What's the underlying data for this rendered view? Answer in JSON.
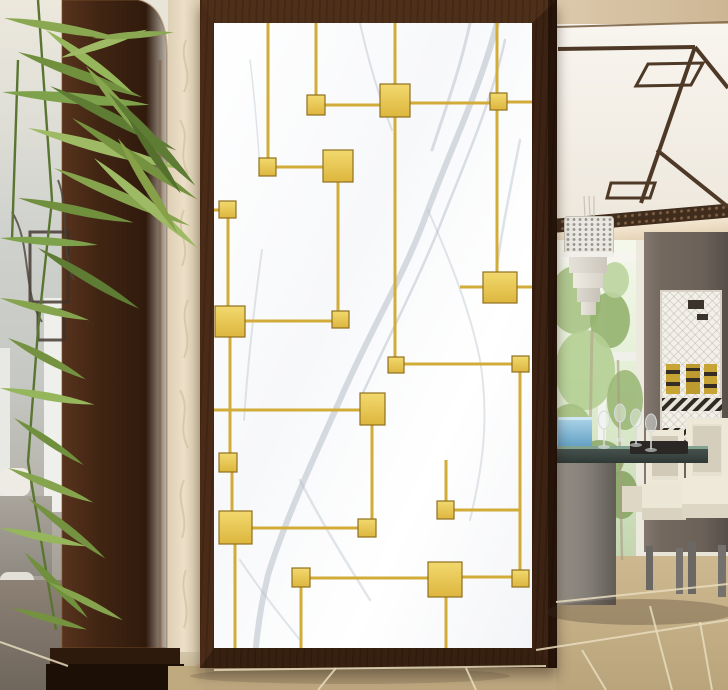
{
  "scene": {
    "description": "Hallway interior photo: white marble partition screen with gold geometric square pattern in a dark wood frame; dark wood arch and bamboo plant at left; dining room with fretwork ceiling, chandelier, window, table and chairs at right; beige tile floor",
    "colors": {
      "gold": "#e7c04c",
      "gold_line": "#d2ac38",
      "gold_edge": "#8f7020",
      "wood": "#4a2b18",
      "wood_dark": "#2a160b",
      "marble": "#fdfdfd",
      "vein": "#b7bec9",
      "wallpaper": "#ecdfc8",
      "fret": "#4e3926",
      "lattice_band": "#3f2c1c",
      "wall_column": "#6f645e",
      "window_green": "#a9c486",
      "floor": "#c3ad85",
      "grout": "#e8dcbd",
      "left_floor": "#847a6e",
      "chair": "#e7e1d1",
      "table": "#37423f",
      "stem": "#5a7531"
    }
  },
  "panel": {
    "vein_color": "#b7bec9",
    "line_color": "#d2ac38",
    "square_edge": "#8f7020",
    "squares": [
      [
        307,
        95,
        18,
        20
      ],
      [
        380,
        84,
        30,
        33
      ],
      [
        490,
        93,
        17,
        17
      ],
      [
        323,
        150,
        30,
        32
      ],
      [
        259,
        158,
        17,
        18
      ],
      [
        219,
        201,
        17,
        17
      ],
      [
        215,
        306,
        30,
        31
      ],
      [
        332,
        311,
        17,
        17
      ],
      [
        483,
        272,
        34,
        31
      ],
      [
        388,
        357,
        16,
        16
      ],
      [
        512,
        356,
        17,
        16
      ],
      [
        360,
        393,
        25,
        32
      ],
      [
        219,
        453,
        18,
        19
      ],
      [
        219,
        511,
        33,
        33
      ],
      [
        358,
        519,
        18,
        18
      ],
      [
        437,
        501,
        17,
        18
      ],
      [
        292,
        568,
        18,
        19
      ],
      [
        428,
        562,
        34,
        35
      ],
      [
        512,
        570,
        17,
        17
      ]
    ],
    "lines": [
      [
        268,
        23,
        268,
        158
      ],
      [
        316,
        23,
        316,
        95
      ],
      [
        395,
        23,
        395,
        84
      ],
      [
        395,
        117,
        395,
        357
      ],
      [
        497,
        23,
        497,
        93
      ],
      [
        497,
        110,
        497,
        272
      ],
      [
        338,
        182,
        338,
        311
      ],
      [
        228,
        218,
        228,
        306
      ],
      [
        230,
        337,
        230,
        453
      ],
      [
        232,
        472,
        232,
        511
      ],
      [
        235,
        544,
        235,
        648
      ],
      [
        372,
        425,
        372,
        519
      ],
      [
        520,
        372,
        520,
        570
      ],
      [
        446,
        460,
        446,
        501
      ],
      [
        446,
        597,
        446,
        648
      ],
      [
        301,
        587,
        301,
        648
      ],
      [
        325,
        105,
        380,
        105
      ],
      [
        410,
        103,
        490,
        103
      ],
      [
        507,
        102,
        532,
        102
      ],
      [
        276,
        167,
        323,
        167
      ],
      [
        214,
        210,
        219,
        210
      ],
      [
        245,
        321,
        332,
        321
      ],
      [
        460,
        287,
        483,
        287
      ],
      [
        517,
        287,
        532,
        287
      ],
      [
        404,
        364,
        512,
        364
      ],
      [
        214,
        410,
        360,
        410
      ],
      [
        252,
        528,
        358,
        528
      ],
      [
        454,
        510,
        520,
        510
      ],
      [
        310,
        578,
        428,
        578
      ],
      [
        462,
        577,
        512,
        577
      ]
    ],
    "veins": [
      {
        "d": "M497,23 C480,90 450,150 428,210 C405,275 370,330 340,400 C315,455 285,520 268,575 C262,600 258,625 256,647",
        "w": 6,
        "o": 0.55
      },
      {
        "d": "M505,40 C492,100 466,160 444,215 C424,268 392,330 362,395",
        "w": 2.5,
        "o": 0.5
      },
      {
        "d": "M470,23 C460,70 445,110 432,150",
        "w": 3,
        "o": 0.5
      },
      {
        "d": "M520,140 C510,190 500,240 497,268",
        "w": 2.5,
        "o": 0.45
      },
      {
        "d": "M428,210 C450,260 470,310 480,360 C490,420 482,470 470,520",
        "w": 2,
        "o": 0.4
      },
      {
        "d": "M262,250 C255,300 248,360 244,420",
        "w": 2,
        "o": 0.4
      },
      {
        "d": "M300,480 C320,520 345,560 370,600",
        "w": 2.5,
        "o": 0.4
      },
      {
        "d": "M240,560 C260,590 280,615 300,640",
        "w": 2,
        "o": 0.4
      },
      {
        "d": "M250,60 C255,100 258,140 260,170",
        "w": 1.5,
        "o": 0.4
      },
      {
        "d": "M360,23 C368,60 380,100 392,130",
        "w": 2,
        "o": 0.45
      }
    ]
  },
  "ceiling_fret": [
    {
      "d": "M557,27 L728,22",
      "w": 2,
      "c": "#8a7257"
    },
    {
      "d": "M558,49 L695,47",
      "w": 4
    },
    {
      "d": "M695,47 L641,203",
      "w": 4
    },
    {
      "d": "M648,64 L703,63 L691,85 L636,86 Z",
      "w": 3
    },
    {
      "d": "M611,183 L655,183 L650,198 L607,198 Z",
      "w": 3
    },
    {
      "d": "M657,150 L728,207",
      "w": 4
    },
    {
      "d": "M728,88 L695,47",
      "w": 4
    }
  ],
  "chandelier_cables": [
    [
      584,
      196,
      585,
      218
    ],
    [
      589,
      196,
      590,
      218
    ],
    [
      594,
      196,
      594,
      218
    ]
  ],
  "window_trees": [
    [
      575,
      300,
      26,
      34,
      "#a8c386"
    ],
    [
      610,
      320,
      20,
      28,
      "#93b26e"
    ],
    [
      585,
      370,
      30,
      40,
      "#b4cf94"
    ],
    [
      625,
      400,
      18,
      30,
      "#9cb878"
    ],
    [
      570,
      430,
      22,
      26,
      "#a4bf80"
    ],
    [
      615,
      280,
      14,
      18,
      "#bcd49e"
    ],
    [
      600,
      460,
      24,
      20,
      "#8fa96a"
    ],
    [
      580,
      505,
      26,
      22,
      "#9db873"
    ],
    [
      622,
      495,
      16,
      24,
      "#8aa566"
    ]
  ],
  "inset_motifs": [
    [
      666,
      364,
      14,
      30,
      "#c7a433"
    ],
    [
      686,
      364,
      14,
      30,
      "#bd9b2e"
    ],
    [
      704,
      364,
      13,
      30,
      "#c7a433"
    ],
    [
      666,
      370,
      14,
      4,
      "#332d26"
    ],
    [
      686,
      378,
      14,
      4,
      "#332d26"
    ],
    [
      704,
      372,
      13,
      4,
      "#332d26"
    ],
    [
      666,
      382,
      14,
      4,
      "#332d26"
    ],
    [
      686,
      368,
      14,
      3,
      "#332d26"
    ],
    [
      704,
      384,
      13,
      4,
      "#332d26"
    ],
    [
      662,
      398,
      60,
      13,
      "stripes"
    ],
    [
      662,
      428,
      60,
      8,
      "stripes"
    ],
    [
      688,
      300,
      16,
      9,
      "#3a342c"
    ],
    [
      697,
      314,
      11,
      6,
      "#3a342c"
    ]
  ],
  "floor_grout": [
    [
      556,
      602,
      728,
      584
    ],
    [
      536,
      650,
      728,
      620
    ],
    [
      214,
      670,
      546,
      666
    ],
    [
      318,
      690,
      336,
      668
    ],
    [
      476,
      690,
      466,
      668
    ],
    [
      606,
      690,
      582,
      650
    ],
    [
      672,
      690,
      650,
      606
    ],
    [
      712,
      690,
      700,
      622
    ],
    [
      0,
      642,
      68,
      666
    ]
  ],
  "glassware": [
    [
      604,
      420
    ],
    [
      620,
      413
    ],
    [
      636,
      418
    ],
    [
      651,
      423
    ]
  ],
  "shadows": [
    {
      "cx": 640,
      "cy": 612,
      "rx": 95,
      "ry": 13,
      "c": "rgba(60,48,36,.28)"
    },
    {
      "cx": 350,
      "cy": 676,
      "rx": 160,
      "ry": 8,
      "c": "rgba(60,48,36,.18)"
    }
  ],
  "left_lattice": [
    {
      "d": "M30,232 H68 V302 H30 Z",
      "w": 3,
      "c": "#3d3129"
    },
    {
      "d": "M38,310 H64 V340 H38 Z",
      "w": 3,
      "c": "#3d3129"
    },
    {
      "d": "M12,212 C32,244 22,292 42,322",
      "w": 2,
      "c": "#4a4338"
    },
    {
      "d": "M58,180 C70,210 60,250 74,280",
      "w": 2,
      "c": "#4a4338"
    }
  ],
  "wallpaper_scrolls": [
    {
      "d": "M186,40 C178,60 194,70 184,92"
    },
    {
      "d": "M180,120 C192,140 176,150 188,174"
    },
    {
      "d": "M184,210 C174,232 192,242 182,266"
    },
    {
      "d": "M188,300 C178,322 194,334 184,358"
    },
    {
      "d": "M180,390 C192,412 176,424 188,448"
    },
    {
      "d": "M184,480 C174,502 190,514 182,538"
    },
    {
      "d": "M186,570 C178,592 192,604 184,628"
    }
  ],
  "plant": {
    "stem_color": "#5a7531",
    "stems": [
      [
        38,
        0,
        52,
        200
      ],
      [
        52,
        200,
        38,
        330
      ],
      [
        38,
        330,
        28,
        462
      ],
      [
        28,
        462,
        56,
        630
      ],
      [
        18,
        60,
        12,
        240
      ]
    ],
    "leaves": [
      [
        4,
        18,
        118,
        9,
        10,
        "#8aa851"
      ],
      [
        18,
        52,
        132,
        10,
        20,
        "#70903e"
      ],
      [
        46,
        30,
        108,
        9,
        36,
        "#96b65c"
      ],
      [
        2,
        92,
        148,
        11,
        5,
        "#7ea24b"
      ],
      [
        50,
        86,
        142,
        10,
        27,
        "#5e7c34"
      ],
      [
        86,
        66,
        118,
        10,
        50,
        "#88a650"
      ],
      [
        28,
        128,
        158,
        11,
        15,
        "#9eba64"
      ],
      [
        72,
        118,
        150,
        10,
        33,
        "#74923f"
      ],
      [
        108,
        92,
        128,
        10,
        47,
        "#5e7c34"
      ],
      [
        54,
        168,
        148,
        10,
        23,
        "#86a44e"
      ],
      [
        94,
        158,
        138,
        10,
        41,
        "#9eba64"
      ],
      [
        18,
        198,
        118,
        9,
        12,
        "#70903e"
      ],
      [
        118,
        138,
        112,
        9,
        58,
        "#87a149"
      ],
      [
        0,
        238,
        98,
        8,
        4,
        "#7ea24b"
      ],
      [
        38,
        248,
        118,
        9,
        31,
        "#5e7c34"
      ],
      [
        60,
        58,
        92,
        8,
        -18,
        "#9eba64"
      ],
      [
        92,
        38,
        82,
        7,
        -4,
        "#8aa851"
      ],
      [
        128,
        118,
        92,
        8,
        55,
        "#54702c"
      ],
      [
        0,
        298,
        92,
        8,
        14,
        "#86a44e"
      ],
      [
        8,
        338,
        88,
        8,
        28,
        "#74923f"
      ],
      [
        0,
        388,
        96,
        8,
        10,
        "#96b65c"
      ],
      [
        14,
        418,
        84,
        7,
        34,
        "#70903e"
      ],
      [
        8,
        468,
        92,
        8,
        22,
        "#86a44e"
      ],
      [
        28,
        498,
        98,
        8,
        38,
        "#74923f"
      ],
      [
        0,
        528,
        88,
        8,
        12,
        "#96b65c"
      ],
      [
        24,
        552,
        92,
        8,
        46,
        "#70903e"
      ],
      [
        48,
        582,
        84,
        7,
        27,
        "#86a44e"
      ],
      [
        12,
        608,
        78,
        7,
        16,
        "#74923f"
      ]
    ]
  }
}
